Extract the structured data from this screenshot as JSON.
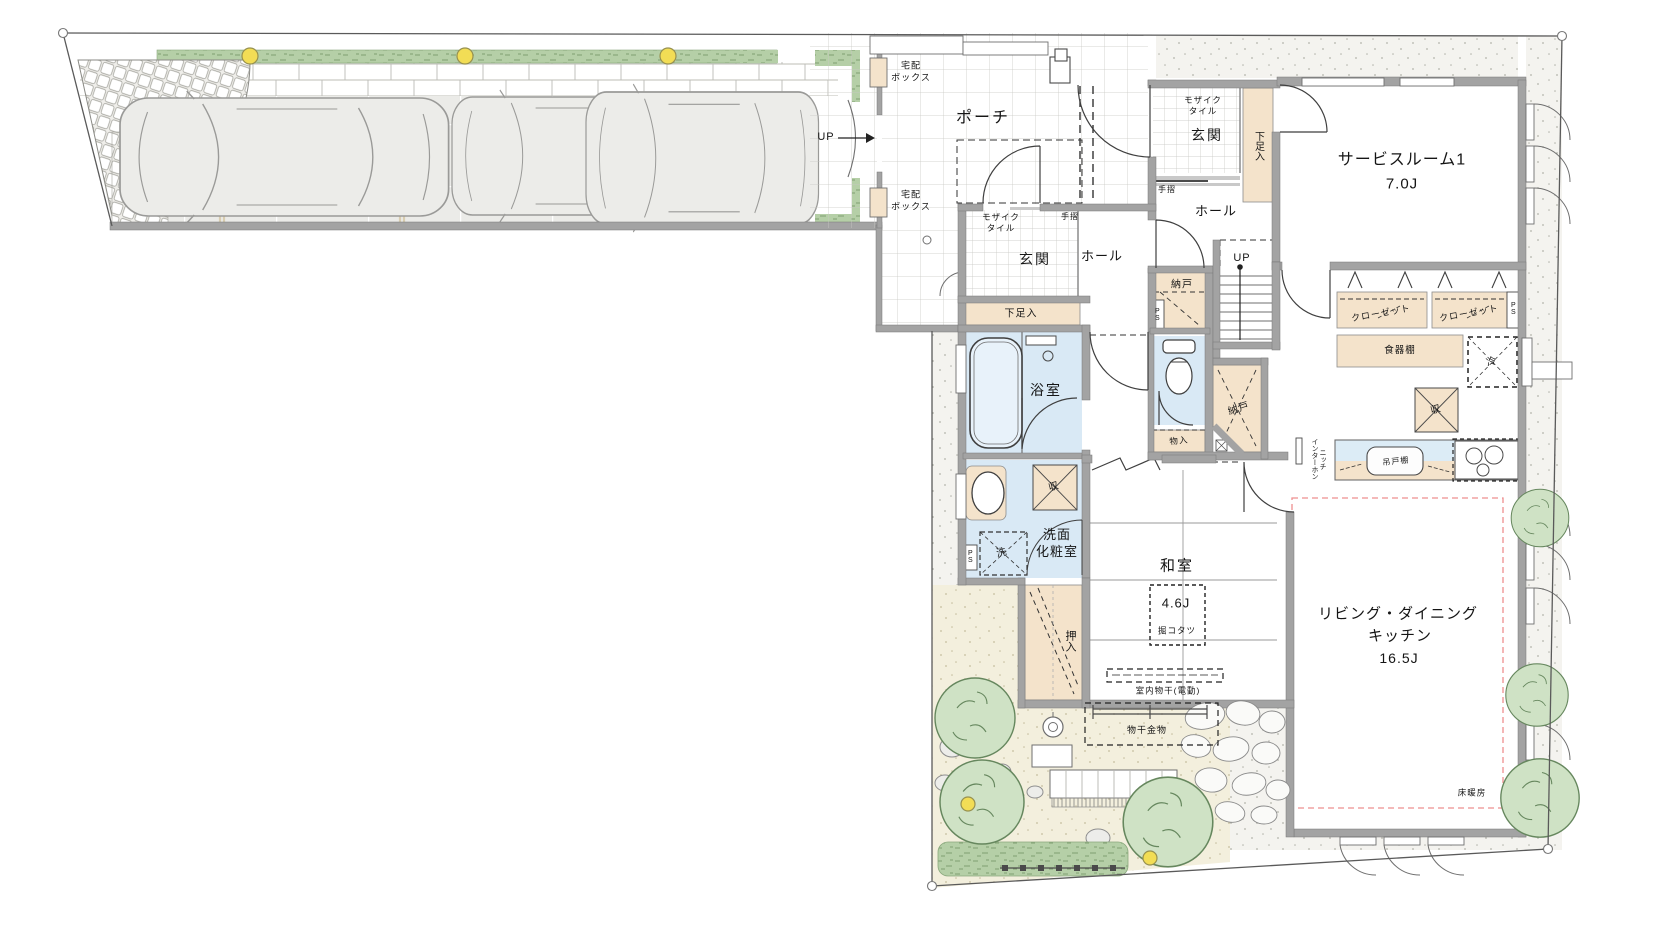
{
  "labels": {
    "up": "UP",
    "porch": "ポーチ",
    "delivery_box": "宅配\nボックス",
    "mosaic_tile": "モザイク\nタイル",
    "entrance": "玄関",
    "hall": "ホール",
    "handrail": "手摺",
    "shoe_cabinet": "下足入",
    "service_room": "サービスルーム1",
    "service_room_size": "7.0J",
    "storage_nando": "納戸",
    "ps": "PS",
    "closet": "クローゼット",
    "dish_cabinet": "食器棚",
    "fridge": "冷",
    "storage_shu": "収",
    "storage_monoire": "物入",
    "hanging_cupboard": "吊戸棚",
    "intercom_niche": "インターホン\nニッチ",
    "bathroom": "浴室",
    "washroom": "洗面\n化粧室",
    "washer": "洗",
    "oshiire": "押入",
    "japanese_room": "和室",
    "japanese_room_size": "4.6J",
    "kotatsu": "掘コタツ",
    "indoor_drying": "室内物干(電動)",
    "drying_hardware": "物干金物",
    "ldk_line1": "リビング・ダイニング",
    "ldk_line2": "キッチン",
    "ldk_size": "16.5J",
    "floor_heating": "床暖房"
  }
}
